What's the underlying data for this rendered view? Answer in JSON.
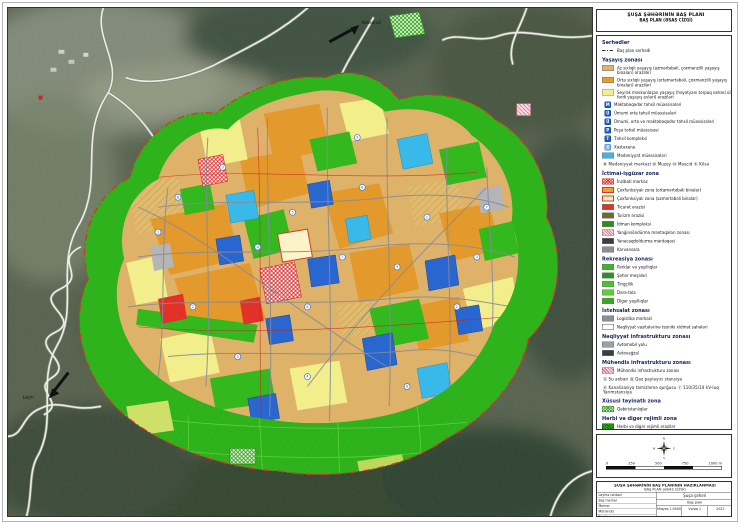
{
  "title": {
    "line1": "ŞUŞA ŞƏHƏRİNİN BAŞ PLANI",
    "line2": "BAŞ PLAN (ƏSAS CİZGİ)"
  },
  "map": {
    "labels": {
      "xankendi": "Xankəndi",
      "lachin": "Laçın"
    },
    "markers": [
      {
        "x": 150,
        "y": 225,
        "n": "1"
      },
      {
        "x": 185,
        "y": 300,
        "n": "2"
      },
      {
        "x": 215,
        "y": 160,
        "n": "3"
      },
      {
        "x": 250,
        "y": 240,
        "n": "4"
      },
      {
        "x": 285,
        "y": 205,
        "n": "5"
      },
      {
        "x": 300,
        "y": 300,
        "n": "6"
      },
      {
        "x": 335,
        "y": 250,
        "n": "7"
      },
      {
        "x": 355,
        "y": 180,
        "n": "8"
      },
      {
        "x": 390,
        "y": 260,
        "n": "9"
      },
      {
        "x": 420,
        "y": 210,
        "n": "1"
      },
      {
        "x": 450,
        "y": 300,
        "n": "2"
      },
      {
        "x": 470,
        "y": 250,
        "n": "3"
      },
      {
        "x": 300,
        "y": 370,
        "n": "4"
      },
      {
        "x": 230,
        "y": 350,
        "n": "5"
      },
      {
        "x": 400,
        "y": 380,
        "n": "6"
      },
      {
        "x": 480,
        "y": 200,
        "n": "7"
      },
      {
        "x": 170,
        "y": 190,
        "n": "8"
      },
      {
        "x": 350,
        "y": 130,
        "n": "9"
      }
    ]
  },
  "legend": {
    "sections": [
      {
        "heading": "Sərhədlər",
        "items": [
          {
            "icon": "dashline",
            "label": "Baş plan sərhədi"
          }
        ]
      },
      {
        "heading": "Yaşayış zonası",
        "items": [
          {
            "icon": "tan",
            "label": "Az sıxlıqlı yaşayış (azmərtəbəli, çoxmənzilli yaşayış binaları) əraziləri"
          },
          {
            "icon": "orange",
            "label": "Orta sıxlıqlı yaşayış (ortamərtəbəli, çoxmənzilli yaşayış binaları) əraziləri"
          },
          {
            "icon": "yellow",
            "label": "Seyrək məskunlaşan yaşayış (həyətyanı torpaq sahəsi olan fərdi yaşayış evləri) əraziləri"
          },
          {
            "icon": "edu",
            "letter": "M",
            "label": "Məktəbəqədər təhsil müəssisələri"
          },
          {
            "icon": "edu",
            "letter": "Ü",
            "label": "Ümumi orta təhsil müəssisələri"
          },
          {
            "icon": "edu",
            "letter": "Ü",
            "label": "Ümumi, orta və məktəbəqədər təhsil müəssisələri"
          },
          {
            "icon": "edu",
            "letter": "P",
            "label": "Peşə təhsil müəssisəsi"
          },
          {
            "icon": "edu",
            "letter": "T",
            "label": "Təhsil kompleksi"
          },
          {
            "icon": "hospital",
            "letter": "X",
            "label": "Xəstəxana"
          },
          {
            "icon": "cyan",
            "label": "Mədəniyyət müəssisələri"
          },
          {
            "icon": "none",
            "label": "Ⓜ Mədəniyyət mərkəzi   Ⓜ Muzey   Ⓜ Məscid   Ⓚ Kilsə"
          }
        ]
      },
      {
        "heading": "İctimai-işgüzar zona",
        "items": [
          {
            "icon": "redhatch",
            "label": "İnzibati mərkəz"
          },
          {
            "icon": "orangeB",
            "label": "Çoxfunksiyalı zona (ortamərtəbəli binalar)"
          },
          {
            "icon": "paleB",
            "label": "Çoxfunksiyalı zona (azmərtəbəli binalar)"
          },
          {
            "icon": "red",
            "label": "Ticarət ərazisi"
          },
          {
            "icon": "pt-olive",
            "label": "Turizm ərazisi"
          },
          {
            "icon": "pt-green",
            "label": "İdman kompleksi"
          },
          {
            "icon": "pinkhatch",
            "label": "Yanğınsöndürmə məntəqələri zonası"
          },
          {
            "icon": "pt-dark",
            "label": "Yanacaqdoldurma məntəqəsi"
          },
          {
            "icon": "pt-gray",
            "label": "Karvansara"
          }
        ]
      },
      {
        "heading": "Rekreasiya zonası",
        "items": [
          {
            "icon": "green1",
            "label": "Parklar və yaşıllıqlar"
          },
          {
            "icon": "green2",
            "label": "Şəhər meşələri"
          },
          {
            "icon": "green3",
            "label": "Tingçilik"
          },
          {
            "icon": "green4",
            "label": "Dərə-tala"
          },
          {
            "icon": "green5",
            "label": "Digər yaşıllıqlar"
          }
        ]
      },
      {
        "heading": "İstehsalat zonası",
        "items": [
          {
            "icon": "pt-gray",
            "label": "Logistika mərkəzi"
          },
          {
            "icon": "white",
            "label": "Nəqliyyat vasitələrinə texniki xidmət sahələri"
          }
        ]
      },
      {
        "heading": "Nəqliyyat infrastrukturu zonası",
        "items": [
          {
            "icon": "graybar",
            "label": "Avtomobil yolu"
          },
          {
            "icon": "pt-dark",
            "label": "Avtovağzal"
          }
        ]
      },
      {
        "heading": "Mühəndis infrastrukturu zonası",
        "items": [
          {
            "icon": "pinkhatch2",
            "label": "Mühəndis infrastrukturu zonası"
          },
          {
            "icon": "none",
            "label": "Ⓢ Su anbarı      Ⓠ Qaz paylayıcı stansiya"
          },
          {
            "icon": "none",
            "label": "Ⓚ Kanalizasiya təmizləmə qurğusu   Ⓨ 110/35/10 kV-luq Yarımstansiya"
          }
        ]
      },
      {
        "heading": "Xüsusi təyinatlı zona",
        "items": [
          {
            "icon": "greenhatch",
            "label": "Qəbiristanlıqlar"
          }
        ]
      },
      {
        "heading": "Hərbi və digər rejimli zona",
        "items": [
          {
            "icon": "darkgreenhatch",
            "label": "Hərbi və digər rejimli ərazilər"
          }
        ]
      }
    ]
  },
  "compass": {
    "n": "N",
    "e": "E",
    "s": "S",
    "w": "W"
  },
  "scalebar": {
    "labels": [
      "0",
      "250",
      "500",
      "750",
      "1000 m"
    ]
  },
  "titleblock": {
    "header1": "ŞUŞA ŞƏHƏRİNİN BAŞ PLANININ HAZIRLANMASI",
    "header2": "BAŞ PLAN (ƏSAS CİZGİ)",
    "roles": [
      "Layihə rəhbəri",
      "Baş memar",
      "Memar",
      "Mühəndis",
      "Tərtibçi"
    ],
    "project": "Şuşa şəhəri",
    "drawing": "Baş plan",
    "scale_label": "Miqyas",
    "scale_value": "1:5000",
    "sheet_label": "Vərəq",
    "sheet_value": "1",
    "year": "2022"
  },
  "colors": {
    "residential_low": "#dfb269",
    "residential_mid": "#e89b25",
    "residential_sparse": "#f3ef8e",
    "education": "#1d5fc6",
    "culture": "#35b8e8",
    "commerce": "#e23128",
    "park_green": "#33b81e",
    "terrain": "#57624e",
    "boundary_red": "#d93425"
  }
}
